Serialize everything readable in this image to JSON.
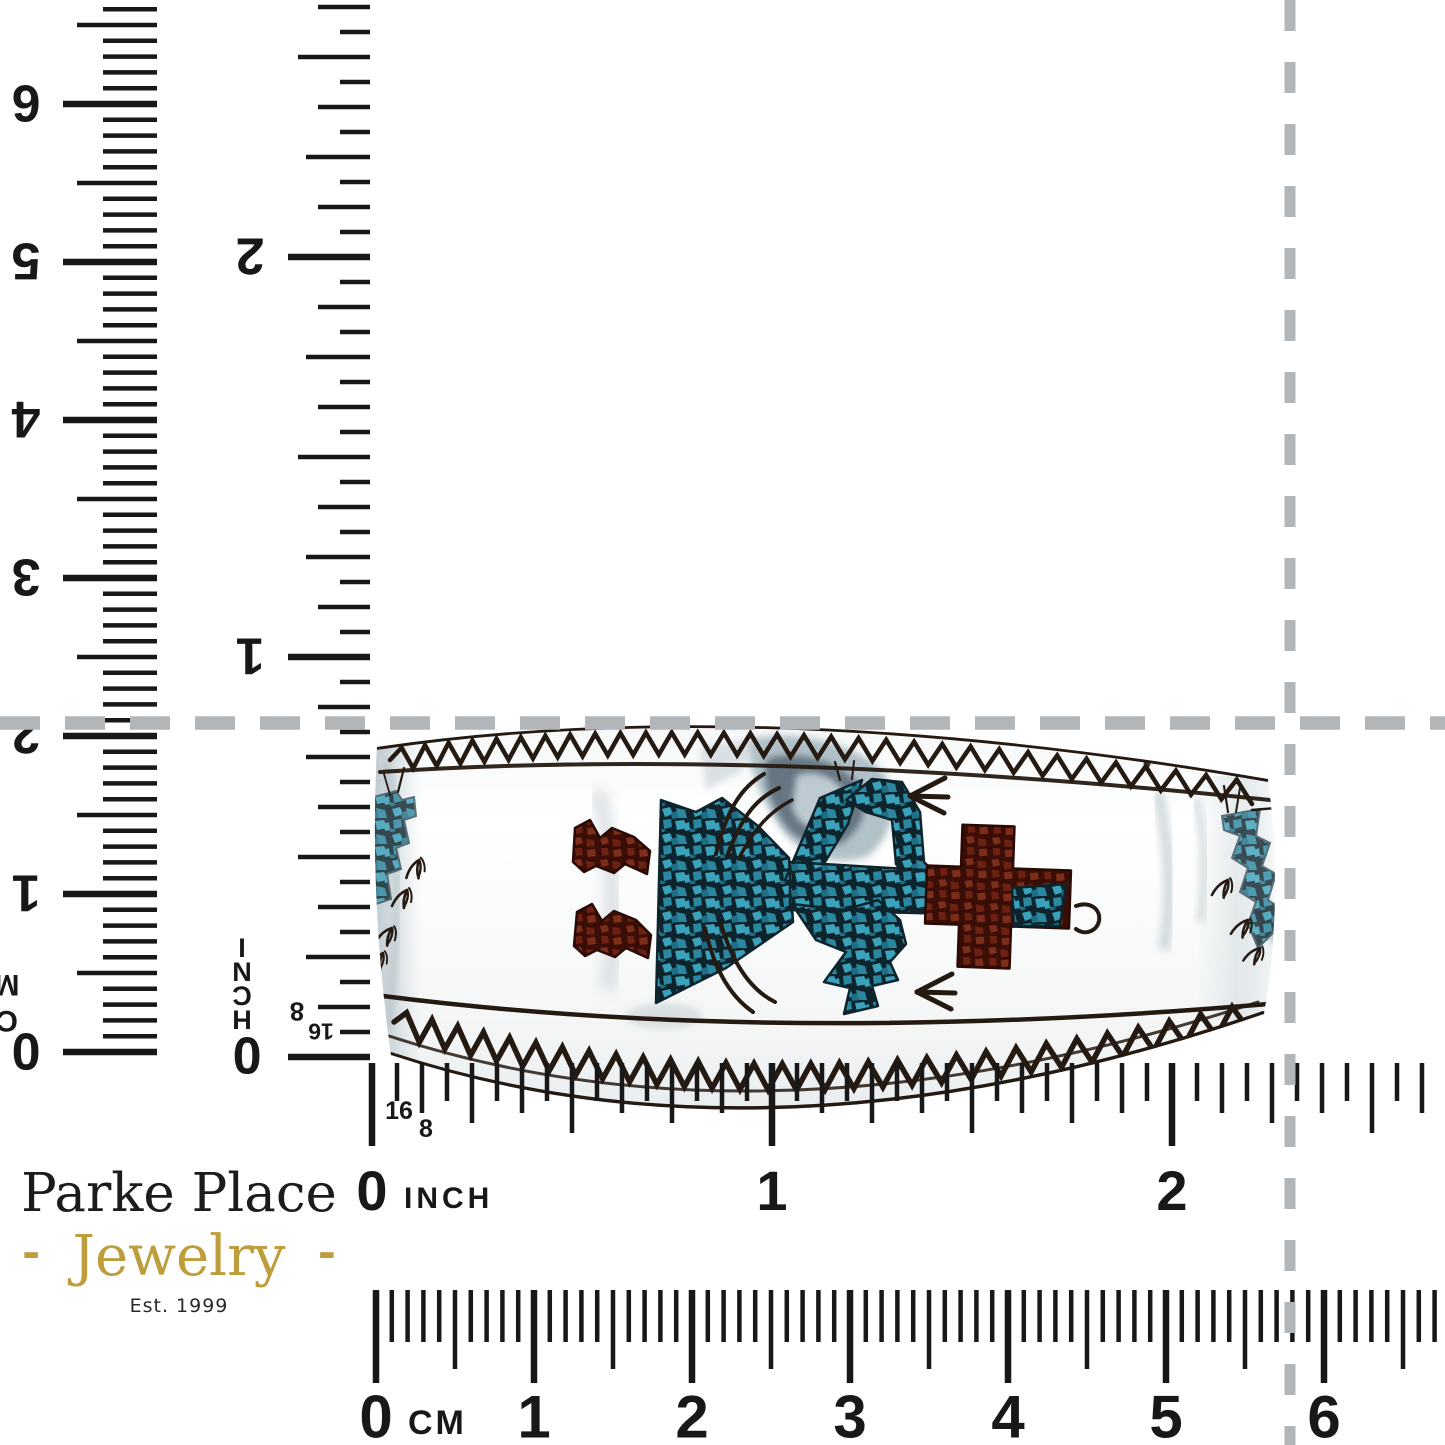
{
  "brand": {
    "name": "Parke Place",
    "subtitle": "Jewelry",
    "subtitle_dash_left": "-",
    "subtitle_dash_right": "-",
    "established": "Est. 1999",
    "gold_color": "#BE9D3C",
    "ink_color": "#1D1C1A"
  },
  "crosshair": {
    "color": "#B2B6B9"
  },
  "rulers": {
    "ink_color": "#181818",
    "bottom_inch": {
      "unit": "INCH",
      "labels": [
        "0",
        "1",
        "2"
      ],
      "fraction_labels": [
        "16",
        "8"
      ]
    },
    "bottom_cm": {
      "unit": "CM",
      "labels": [
        "0",
        "1",
        "2",
        "3",
        "4",
        "5",
        "6"
      ]
    },
    "left_cm": {
      "unit": "CM",
      "labels": [
        "0",
        "1",
        "2",
        "3",
        "4",
        "5",
        "6"
      ]
    },
    "right_inch": {
      "unit": "INCH",
      "labels": [
        "0",
        "1",
        "2"
      ],
      "fraction_labels": [
        "8",
        "16"
      ]
    }
  },
  "bracelet": {
    "colors": {
      "turquoise_light": "#3BA2BC",
      "turquoise_mid": "#2B87A0",
      "turquoise_deep": "#1E6E86",
      "turquoise_matrix": "#0E242C",
      "coral_light": "#7C2E1B",
      "coral_mid": "#6C2113",
      "coral_matrix": "#3A0D06",
      "stamp_ink": "#241A12",
      "silver_shadow": "#9FB2BC"
    }
  }
}
